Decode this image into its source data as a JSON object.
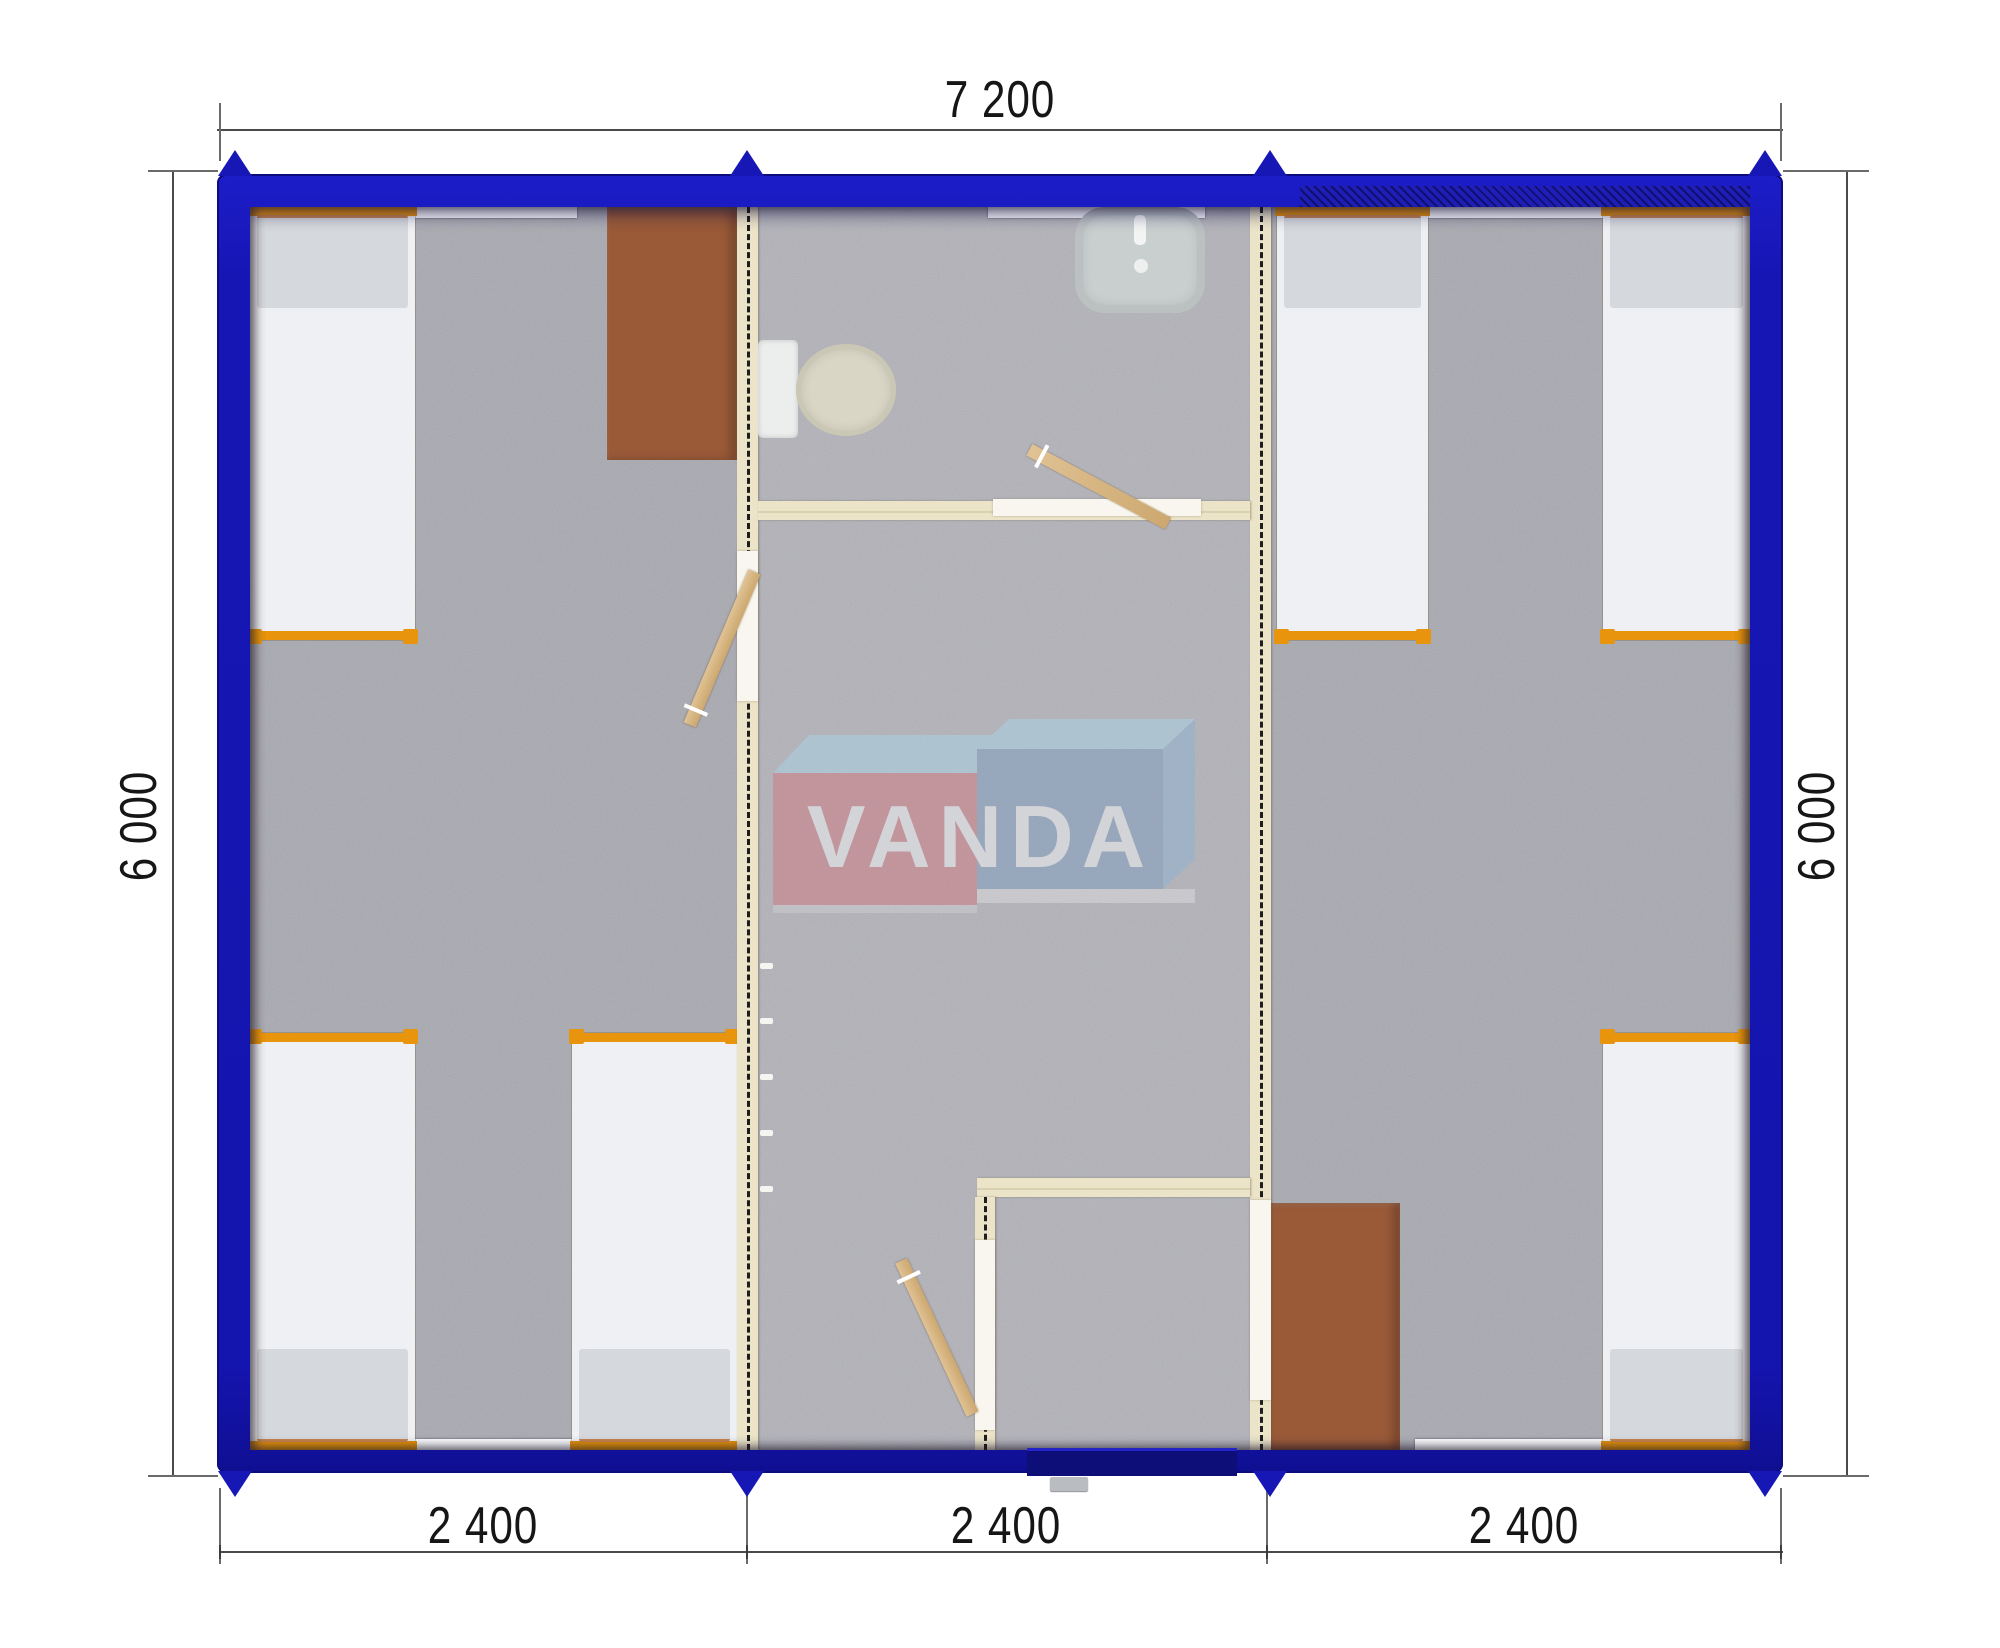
{
  "plan": {
    "watermark_logo_text": "VANDA",
    "dimensions": {
      "overall_width_mm": "7 200",
      "overall_depth_left_mm": "6 000",
      "overall_depth_right_mm": "6 000",
      "module_widths_mm": [
        "2 400",
        "2 400",
        "2 400"
      ]
    },
    "colors": {
      "wall_blue": "#1616b4",
      "frame_orange": "#e8940c",
      "partition_cream": "#ece4c8",
      "carpet_gray": "#a9a9b1",
      "desk_brown": "#9a5a38",
      "logo_red": "#d17981",
      "logo_blue": "#7e9dbe",
      "logo_light_blue": "#a9d4e6"
    },
    "inventory": {
      "modules": 3,
      "beds": 6,
      "desks": 2,
      "toilets": 1,
      "sinks": 1,
      "interior_doors": 3,
      "entrance_doors": 1,
      "window_sills": 5
    }
  }
}
